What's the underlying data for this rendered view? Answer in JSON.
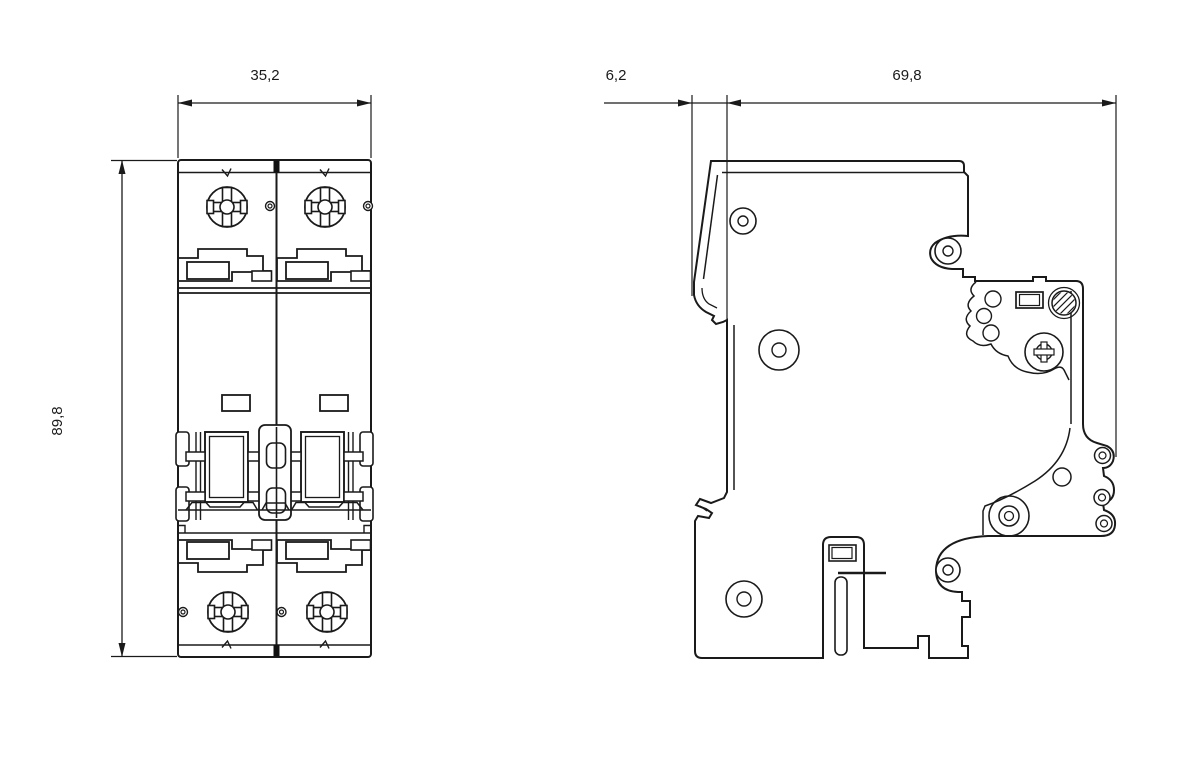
{
  "drawing": {
    "front_view": {
      "width": "35,2",
      "height": "89,8"
    },
    "side_view": {
      "clip_offset": "6,2",
      "depth": "69,8"
    },
    "colors": {
      "line": "#1a1a1a",
      "background": "#ffffff"
    }
  }
}
